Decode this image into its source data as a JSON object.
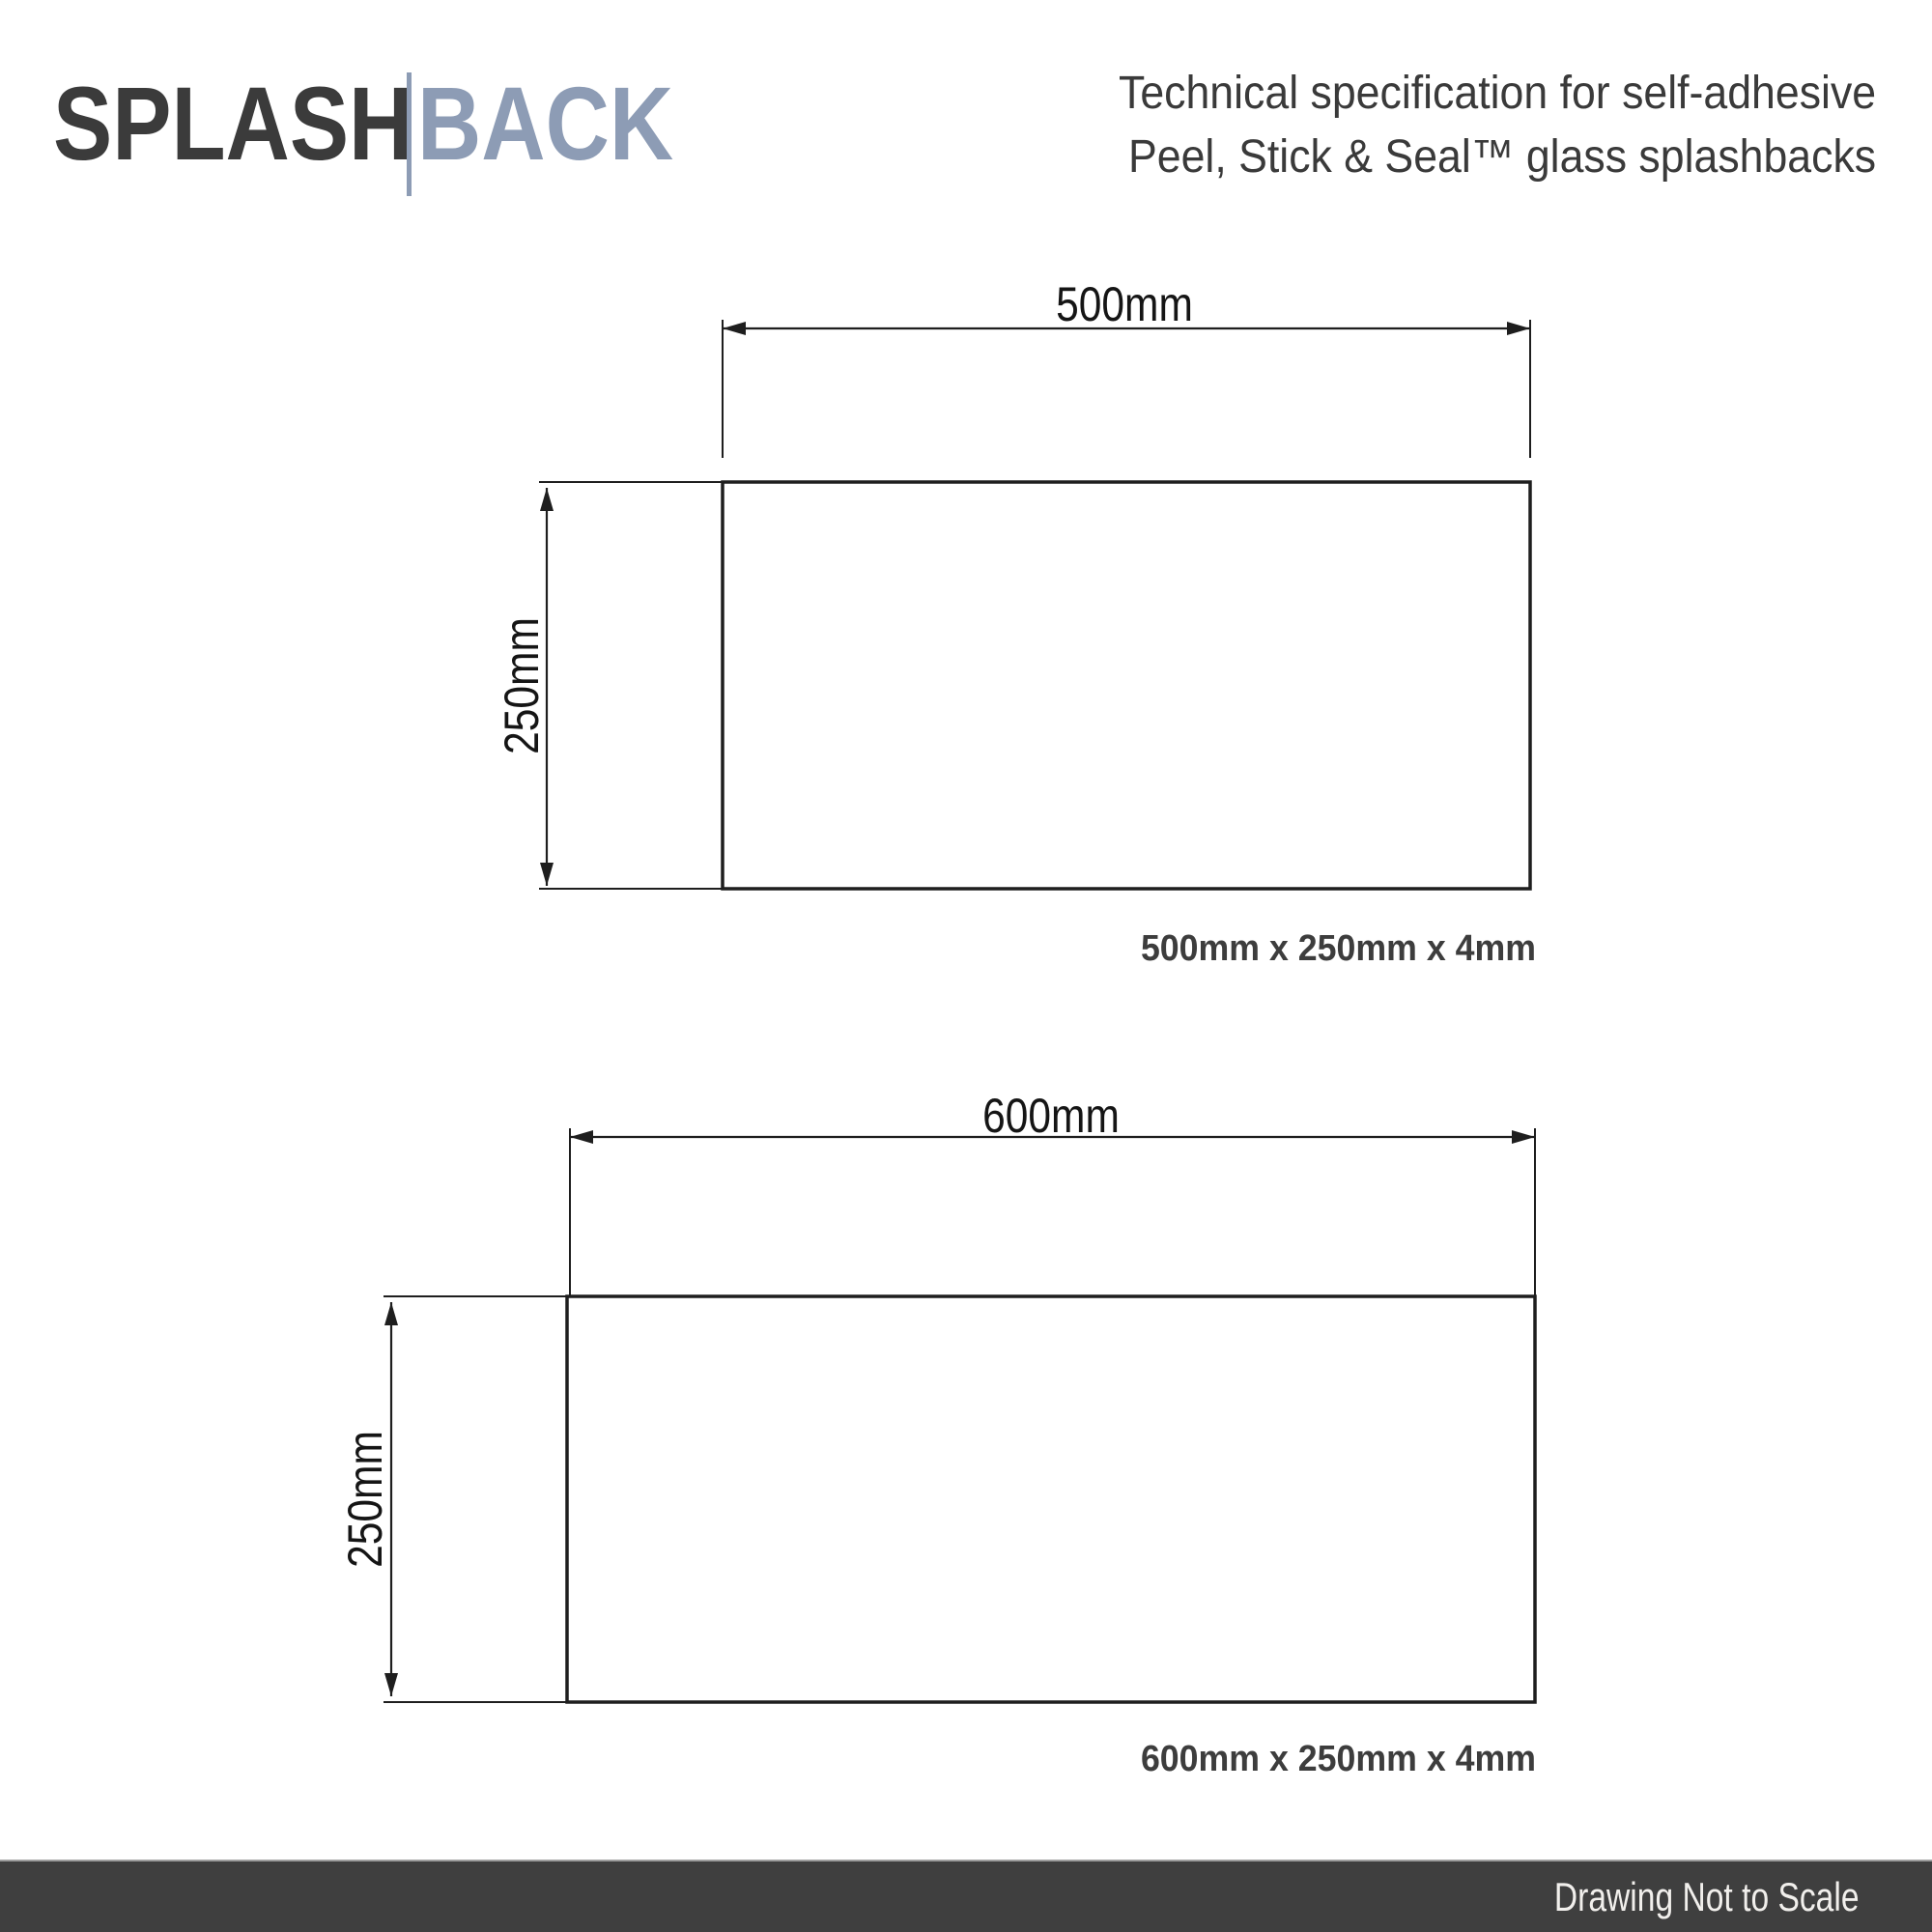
{
  "logo": {
    "part1": "SPLASH",
    "part2": "BACK"
  },
  "title": {
    "line1": "Technical specification for self-adhesive",
    "line2": "Peel, Stick & Seal™ glass splashbacks"
  },
  "drawings": [
    {
      "name": "panel-500x250",
      "width_label": "500mm",
      "height_label": "250mm",
      "caption": "500mm x 250mm x 4mm"
    },
    {
      "name": "panel-600x250",
      "width_label": "600mm",
      "height_label": "250mm",
      "caption": "600mm x 250mm x 4mm"
    }
  ],
  "footer": {
    "note": "Drawing Not to Scale"
  },
  "colors": {
    "logo_primary": "#3b3b3b",
    "logo_secondary": "#8d9cb5",
    "heading_text": "#3a3a3a",
    "drawing_line": "#1e1e1e",
    "caption_text": "#3d3d3d",
    "footer_bg": "#3f3f3f",
    "footer_text": "#f1efec"
  }
}
